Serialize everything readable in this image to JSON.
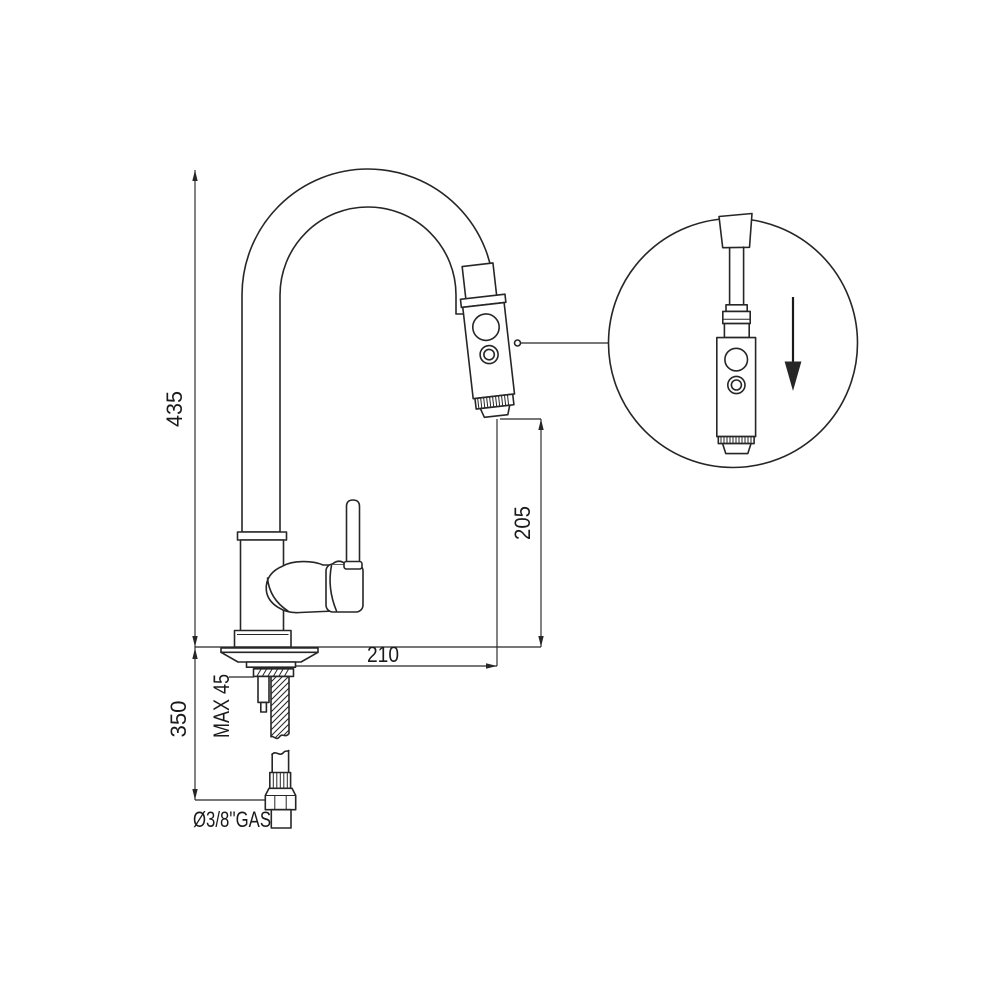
{
  "drawing": {
    "background": "#ffffff",
    "line_color": "#262626",
    "dimensions": {
      "total_height": "435",
      "outlet_to_counter": "205",
      "spout_reach": "210",
      "below_counter": "350",
      "max_counter_thickness": "MAX 45",
      "supply_connection": "Ø3/8''GAS"
    },
    "icons": {
      "pull_direction": "down-arrow-icon",
      "detail_reference": "leader-dot-icon"
    }
  }
}
